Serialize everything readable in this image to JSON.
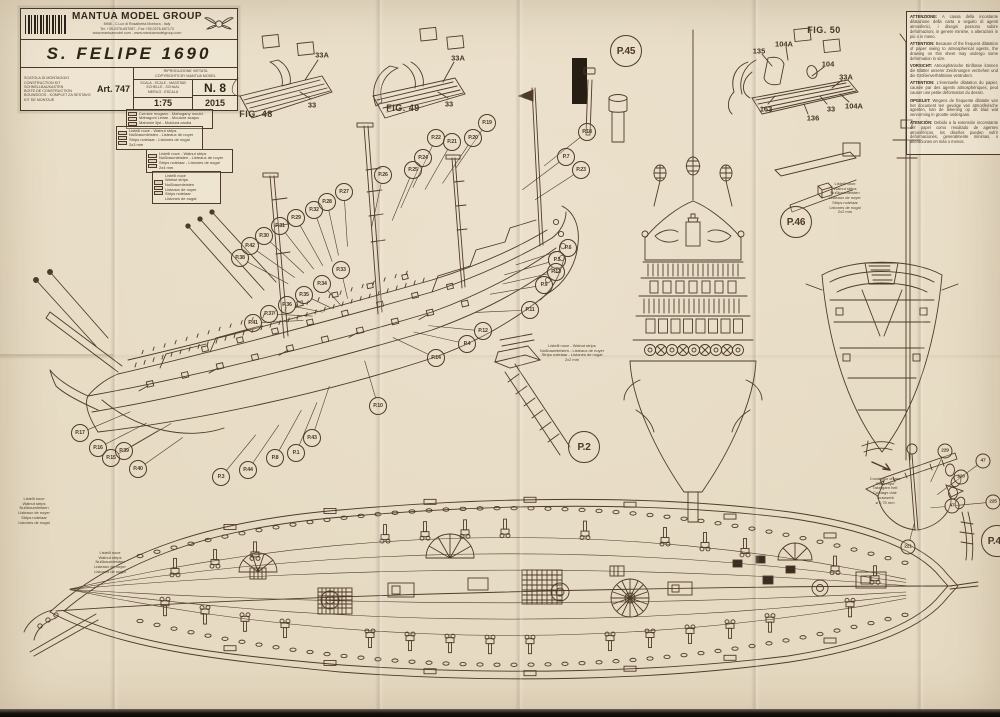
{
  "colors": {
    "paper": "#eadfc9",
    "ink": "#4e3b2b",
    "title_ink": "#2e2418",
    "scan_edge": "#14100b"
  },
  "title_block": {
    "brand": "MANTUA MODEL GROUP",
    "brand_sub1": "MM8 - C.Lux di Rosalberta Montora - Italy",
    "brand_sub2": "Tel. +39-0376-657087 - Fax +39-0376-657173",
    "brand_sub3": "www.mantuamodel.com - www.mantuamodelgroup.com",
    "ship_name": "S. FELIPE 1690",
    "kit_lines": [
      "SCATOLA DI MONTAGGIO",
      "CONSTRUCTION KIT",
      "SCHNELLBAUKASTEN",
      "BOITE DE CONSTRUCTION",
      "BOUWDOOS - KOMPLET ZA SESTAVO",
      "KIT DE MONTAJE"
    ],
    "art_no": "Art. 747",
    "copyright_line1": "RIPRODUZIONE VIETATA",
    "copyright_line2": "COPYRIGHTS BY MANTUA MODEL",
    "scale_lines": [
      "SCALA - SCALE - MASSTAB",
      "ECHELLE - SCHAAL",
      "MERILO - ESCALA"
    ],
    "scale_value": "1:75",
    "sheet_no": "N. 8",
    "year": "2015"
  },
  "warning_box": {
    "items": [
      {
        "lead": "ATTENZIONE:",
        "text": " A causa della incostante dilatazione della carta a seguito di agenti atmosferici, i disegni possono subire deformazioni, in genere minime, o alterazioni in più o in meno."
      },
      {
        "lead": "ATTENTION:",
        "text": " Because of the frequent dilatation of paper owing to atmospherical agents, the drawing on this sheet may undergo some deformation in size."
      },
      {
        "lead": "VORSICHT:",
        "text": " Atmosphärische Einflüsse können die Blätter unserer Zeichnungen verziehen und die Größenverhältnisse verändern."
      },
      {
        "lead": "ATTENTION:",
        "text": " L'éventuelle dilatation du papier, causée par des agents atmosphériques, peut causer une petite déformation du dessin."
      },
      {
        "lead": "OPGELET:",
        "text": " Wegens de frequente dilatatie van het document ten gevolge van atmosferische agenten, kan de tekening op dit blad wat vervorming in grootte ondergaan."
      },
      {
        "lead": "ATENCIÓN:",
        "text": " Debido a la extensión inconstante del papel como resultado de agentes atmosféricos, los diseños pueden sufrir deformaciones, generalmente mínimas, o alteraciones en más o menos."
      }
    ]
  },
  "callouts": [
    {
      "label": "P.17",
      "x": 80,
      "y": 433,
      "g": "ship"
    },
    {
      "label": "P.16",
      "x": 98,
      "y": 448,
      "g": "ship"
    },
    {
      "label": "P.15",
      "x": 111,
      "y": 458,
      "g": "ship"
    },
    {
      "label": "P.39",
      "x": 124,
      "y": 451,
      "g": "ship"
    },
    {
      "label": "P.40",
      "x": 138,
      "y": 469,
      "g": "ship"
    },
    {
      "label": "P.3",
      "x": 221,
      "y": 477,
      "g": "ship"
    },
    {
      "label": "P.44",
      "x": 248,
      "y": 470,
      "g": "ship"
    },
    {
      "label": "P.8",
      "x": 275,
      "y": 458,
      "g": "ship"
    },
    {
      "label": "P.1",
      "x": 296,
      "y": 453,
      "g": "ship"
    },
    {
      "label": "P.43",
      "x": 312,
      "y": 438,
      "g": "ship"
    },
    {
      "label": "P.10",
      "x": 378,
      "y": 406,
      "g": "ship"
    },
    {
      "label": "P.38",
      "x": 240,
      "y": 258,
      "g": "ship"
    },
    {
      "label": "P.42",
      "x": 250,
      "y": 246,
      "g": "ship"
    },
    {
      "label": "P.30",
      "x": 264,
      "y": 236,
      "g": "ship"
    },
    {
      "label": "P.31",
      "x": 280,
      "y": 226,
      "g": "ship"
    },
    {
      "label": "P.29",
      "x": 296,
      "y": 218,
      "g": "ship"
    },
    {
      "label": "P.32",
      "x": 314,
      "y": 210,
      "g": "ship"
    },
    {
      "label": "P.28",
      "x": 327,
      "y": 202,
      "g": "ship"
    },
    {
      "label": "P.27",
      "x": 344,
      "y": 192,
      "g": "ship"
    },
    {
      "label": "P.26",
      "x": 383,
      "y": 175,
      "g": "ship"
    },
    {
      "label": "P.25",
      "x": 413,
      "y": 170,
      "g": "ship"
    },
    {
      "label": "P.24",
      "x": 423,
      "y": 158,
      "g": "ship"
    },
    {
      "label": "P.22",
      "x": 436,
      "y": 138,
      "g": "ship"
    },
    {
      "label": "P.21",
      "x": 452,
      "y": 142,
      "g": "ship"
    },
    {
      "label": "P.20",
      "x": 473,
      "y": 138,
      "g": "ship"
    },
    {
      "label": "P.19",
      "x": 487,
      "y": 123,
      "g": "ship"
    },
    {
      "label": "P.18",
      "x": 587,
      "y": 132,
      "g": "ship"
    },
    {
      "label": "P.7",
      "x": 566,
      "y": 157,
      "g": "ship"
    },
    {
      "label": "P.23",
      "x": 581,
      "y": 170,
      "g": "ship"
    },
    {
      "label": "P.6",
      "x": 568,
      "y": 248,
      "g": "ship"
    },
    {
      "label": "P.5",
      "x": 557,
      "y": 260,
      "g": "ship"
    },
    {
      "label": "P.13",
      "x": 556,
      "y": 272,
      "g": "ship"
    },
    {
      "label": "P.9",
      "x": 544,
      "y": 285,
      "g": "ship"
    },
    {
      "label": "P.11",
      "x": 530,
      "y": 310,
      "g": "ship"
    },
    {
      "label": "P.33",
      "x": 341,
      "y": 270,
      "g": "ship"
    },
    {
      "label": "P.34",
      "x": 322,
      "y": 284,
      "g": "ship"
    },
    {
      "label": "P.35",
      "x": 304,
      "y": 295,
      "g": "ship"
    },
    {
      "label": "P.36",
      "x": 287,
      "y": 305,
      "g": "ship"
    },
    {
      "label": "P.37",
      "x": 269,
      "y": 314,
      "g": "ship"
    },
    {
      "label": "P.41",
      "x": 253,
      "y": 323,
      "g": "ship"
    },
    {
      "label": "P.4",
      "x": 467,
      "y": 344,
      "g": "ship"
    },
    {
      "label": "P.12",
      "x": 483,
      "y": 331,
      "g": "ship"
    },
    {
      "label": "P.14",
      "x": 436,
      "y": 358,
      "g": "ship"
    },
    {
      "label": "P.45",
      "x": 626,
      "y": 51,
      "size": "lg"
    },
    {
      "label": "P.46",
      "x": 796,
      "y": 222,
      "size": "lg"
    },
    {
      "label": "P.2",
      "x": 584,
      "y": 447,
      "size": "lg"
    },
    {
      "label": "P.47",
      "x": 997,
      "y": 541,
      "size": "lg"
    },
    {
      "label": "229",
      "x": 945,
      "y": 451,
      "size": "sm",
      "g": "anchor"
    },
    {
      "label": "220",
      "x": 961,
      "y": 477,
      "size": "sm",
      "g": "anchor"
    },
    {
      "label": "47",
      "x": 983,
      "y": 461,
      "size": "sm",
      "g": "anchor"
    },
    {
      "label": "47",
      "x": 952,
      "y": 506,
      "size": "sm",
      "g": "anchor"
    },
    {
      "label": "221",
      "x": 908,
      "y": 547,
      "size": "sm",
      "g": "anchor"
    },
    {
      "label": "225",
      "x": 993,
      "y": 502,
      "size": "sm",
      "g": "anchor"
    }
  ],
  "part_labels": [
    {
      "text": "FIG. 48",
      "x": 256,
      "y": 114,
      "cls": "fig"
    },
    {
      "text": "FIG. 49",
      "x": 403,
      "y": 108,
      "cls": "fig"
    },
    {
      "text": "FIG. 50",
      "x": 824,
      "y": 30,
      "cls": "fig"
    },
    {
      "text": "33A",
      "x": 322,
      "y": 55
    },
    {
      "text": "33",
      "x": 312,
      "y": 105
    },
    {
      "text": "33A",
      "x": 458,
      "y": 58
    },
    {
      "text": "33",
      "x": 449,
      "y": 104
    },
    {
      "text": "135",
      "x": 759,
      "y": 51
    },
    {
      "text": "104A",
      "x": 784,
      "y": 44
    },
    {
      "text": "104",
      "x": 828,
      "y": 64
    },
    {
      "text": "33A",
      "x": 846,
      "y": 77
    },
    {
      "text": "163",
      "x": 766,
      "y": 109
    },
    {
      "text": "33",
      "x": 831,
      "y": 109
    },
    {
      "text": "136",
      "x": 813,
      "y": 118
    },
    {
      "text": "104A",
      "x": 854,
      "y": 106
    }
  ],
  "legends": [
    {
      "x": 126,
      "y": 109,
      "w": 82,
      "boxed": true,
      "lines": [
        "Cornice mogano - Mahogany mould.",
        "Mahagoni Leiste - Moulure acajou",
        "Mahonie lijst - Moldura caoba"
      ]
    },
    {
      "x": 116,
      "y": 126,
      "w": 82,
      "boxed": true,
      "lines": [
        "Listelli noce - Walnut strips",
        "Nußbaumleisten - Listeaux de noyer",
        "Strips notelaar - Listones de nogal",
        "2x3 mm"
      ]
    },
    {
      "x": 146,
      "y": 149,
      "w": 82,
      "boxed": true,
      "lines": [
        "Listelli noce - Walnut strips",
        "Nußbaumleisten - Listeaux de noyer",
        "Strips notelaar - Listones de nogal",
        "2x4 mm"
      ]
    },
    {
      "x": 152,
      "y": 171,
      "w": 64,
      "boxed": true,
      "lines": [
        "Listelli noce",
        "Walnut strips",
        "Nußbaumleisten",
        "Listeaux de noyer",
        "Strips notelaar",
        "Listones de nogal"
      ]
    },
    {
      "x": 8,
      "y": 497,
      "w": 52,
      "boxed": false,
      "lines": [
        "Listelli noce",
        "Walnut strips",
        "Nußbaumleisten",
        "Listeaux de noyer",
        "Strips notelaar",
        "Listones de nogal"
      ]
    },
    {
      "x": 84,
      "y": 551,
      "w": 52,
      "boxed": false,
      "lines": [
        "Listelli noce",
        "Walnut strips",
        "Nußbaumleisten",
        "Listeaux de noyer",
        "Listones de nogal"
      ]
    },
    {
      "x": 528,
      "y": 344,
      "w": 88,
      "boxed": false,
      "lines": [
        "Listelli noce - Walnut strips",
        "Nußbaumleisten - Listeaux de noyer",
        "Strips notelaar - Listones de nogal",
        "2x2 mm"
      ]
    },
    {
      "x": 816,
      "y": 182,
      "w": 58,
      "boxed": false,
      "lines": [
        "Listelli noce",
        "Walnut strips",
        "Nußbaumleisten",
        "Listeaux de noyer",
        "Strips notelaar",
        "Listones de nogal",
        "2x2 mm"
      ]
    },
    {
      "x": 862,
      "y": 477,
      "w": 46,
      "boxed": false,
      "lines": [
        "Cordaggio chiaro",
        "Clear rope",
        "Takelgarn hell",
        "Cordage clair",
        "Touwwerk",
        "ø 0,75 mm"
      ]
    }
  ]
}
